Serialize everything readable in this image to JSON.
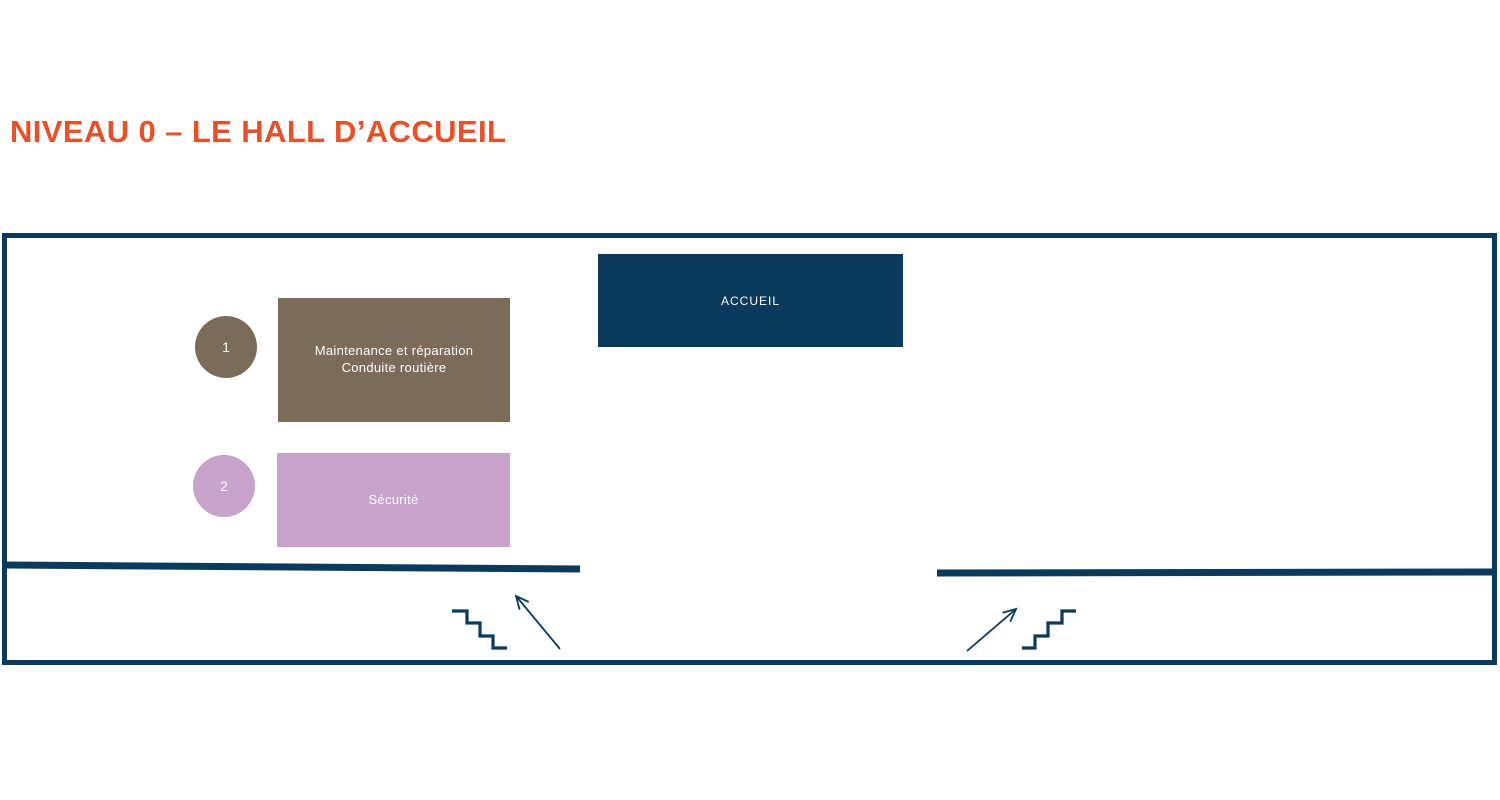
{
  "title": "NIVEAU 0 – LE HALL D’ACCUEIL",
  "colors": {
    "orange": "#E4512A",
    "navy": "#0B3A5D",
    "brown": "#7D6B59",
    "purple": "#C7A2CB"
  },
  "floorplan": {
    "reception": {
      "label": "ACCUEIL"
    },
    "zones": [
      {
        "number": "1",
        "line1": "Maintenance et réparation",
        "line2": "Conduite routière",
        "color": "#7D6B59"
      },
      {
        "number": "2",
        "line1": "Sécurité",
        "line2": "",
        "color": "#C7A2CB"
      }
    ],
    "icons": {
      "stairs_left": "stairs-descending-icon",
      "arrow_left": "arrow-up-left-icon",
      "stairs_right": "stairs-ascending-icon",
      "arrow_right": "arrow-up-right-icon"
    }
  }
}
